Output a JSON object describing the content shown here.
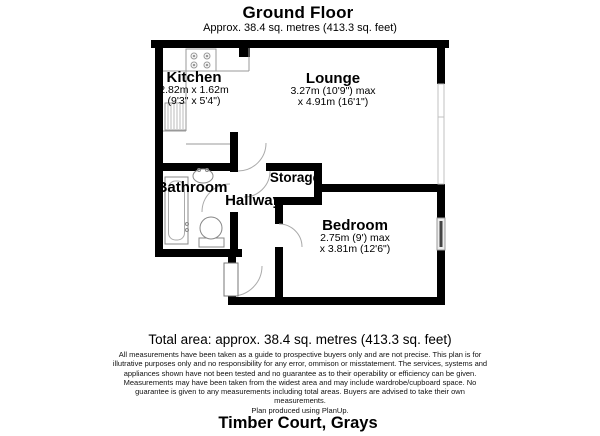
{
  "header": {
    "title": "Ground Floor",
    "subtitle": "Approx. 38.4 sq. metres (413.3 sq. feet)"
  },
  "rooms": {
    "kitchen": {
      "name": "Kitchen",
      "dims1": "2.82m x 1.62m",
      "dims2": "(9'3\" x 5'4\")"
    },
    "lounge": {
      "name": "Lounge",
      "dims1": "3.27m (10'9\") max",
      "dims2": "x 4.91m (16'1\")"
    },
    "bathroom": {
      "name": "Bathroom"
    },
    "hallway": {
      "name": "Hallway"
    },
    "storage": {
      "name": "Storage"
    },
    "bedroom": {
      "name": "Bedroom",
      "dims1": "2.75m (9') max",
      "dims2": "x 3.81m (12'6\")"
    }
  },
  "total_area": "Total area: approx. 38.4 sq. metres (413.3 sq. feet)",
  "disclaimer": {
    "lines": [
      "All measurements have been taken as a guide to prospective buyers only and are not precise. This plan is for",
      "illutrative purposes only and no responsibility for any error, ommison or misstatement. The services, systems and",
      "appliances shown have not been tested and no guarantee as to their operability or efficiency can be given.",
      "Measurements may have been taken from the widest area and may include wardrobe/cupboard space. No",
      "guarantee is given to any measurements including total areas. Buyers are advised to take their own",
      "measurements."
    ]
  },
  "credit": "Plan produced using PlanUp.",
  "footer": {
    "address": "Timber Court, Grays"
  },
  "colors": {
    "wall": "#000000",
    "text": "#000000",
    "fixture_line": "#999999",
    "window_line": "#c0c0c0"
  }
}
